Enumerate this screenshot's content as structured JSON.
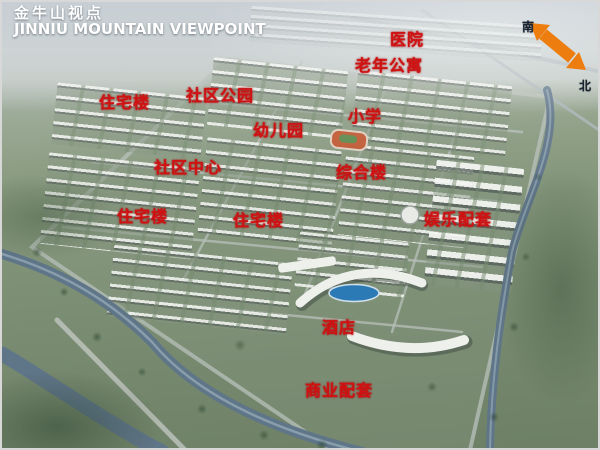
{
  "header": {
    "title_zh": "金牛山视点",
    "title_en": "JINNIU MOUNTAIN VIEWPOINT"
  },
  "compass": {
    "south": "南",
    "north": "北",
    "arrow_color": "#ed7d0e"
  },
  "map_labels": [
    {
      "text": "医院"
    },
    {
      "text": "老年公寓"
    },
    {
      "text": "住宅楼"
    },
    {
      "text": "社区公园"
    },
    {
      "text": "幼儿园"
    },
    {
      "text": "小学"
    },
    {
      "text": "社区中心"
    },
    {
      "text": "综合楼"
    },
    {
      "text": "住宅楼"
    },
    {
      "text": "住宅楼"
    },
    {
      "text": "娱乐配套"
    },
    {
      "text": "酒店"
    },
    {
      "text": "商业配套"
    }
  ],
  "colors": {
    "label_red": "#d01212",
    "title_white": "#ffffff",
    "water_blue": "#5f7588",
    "pool_blue": "#2b7ab6",
    "compass_orange": "#ed7d0e"
  }
}
